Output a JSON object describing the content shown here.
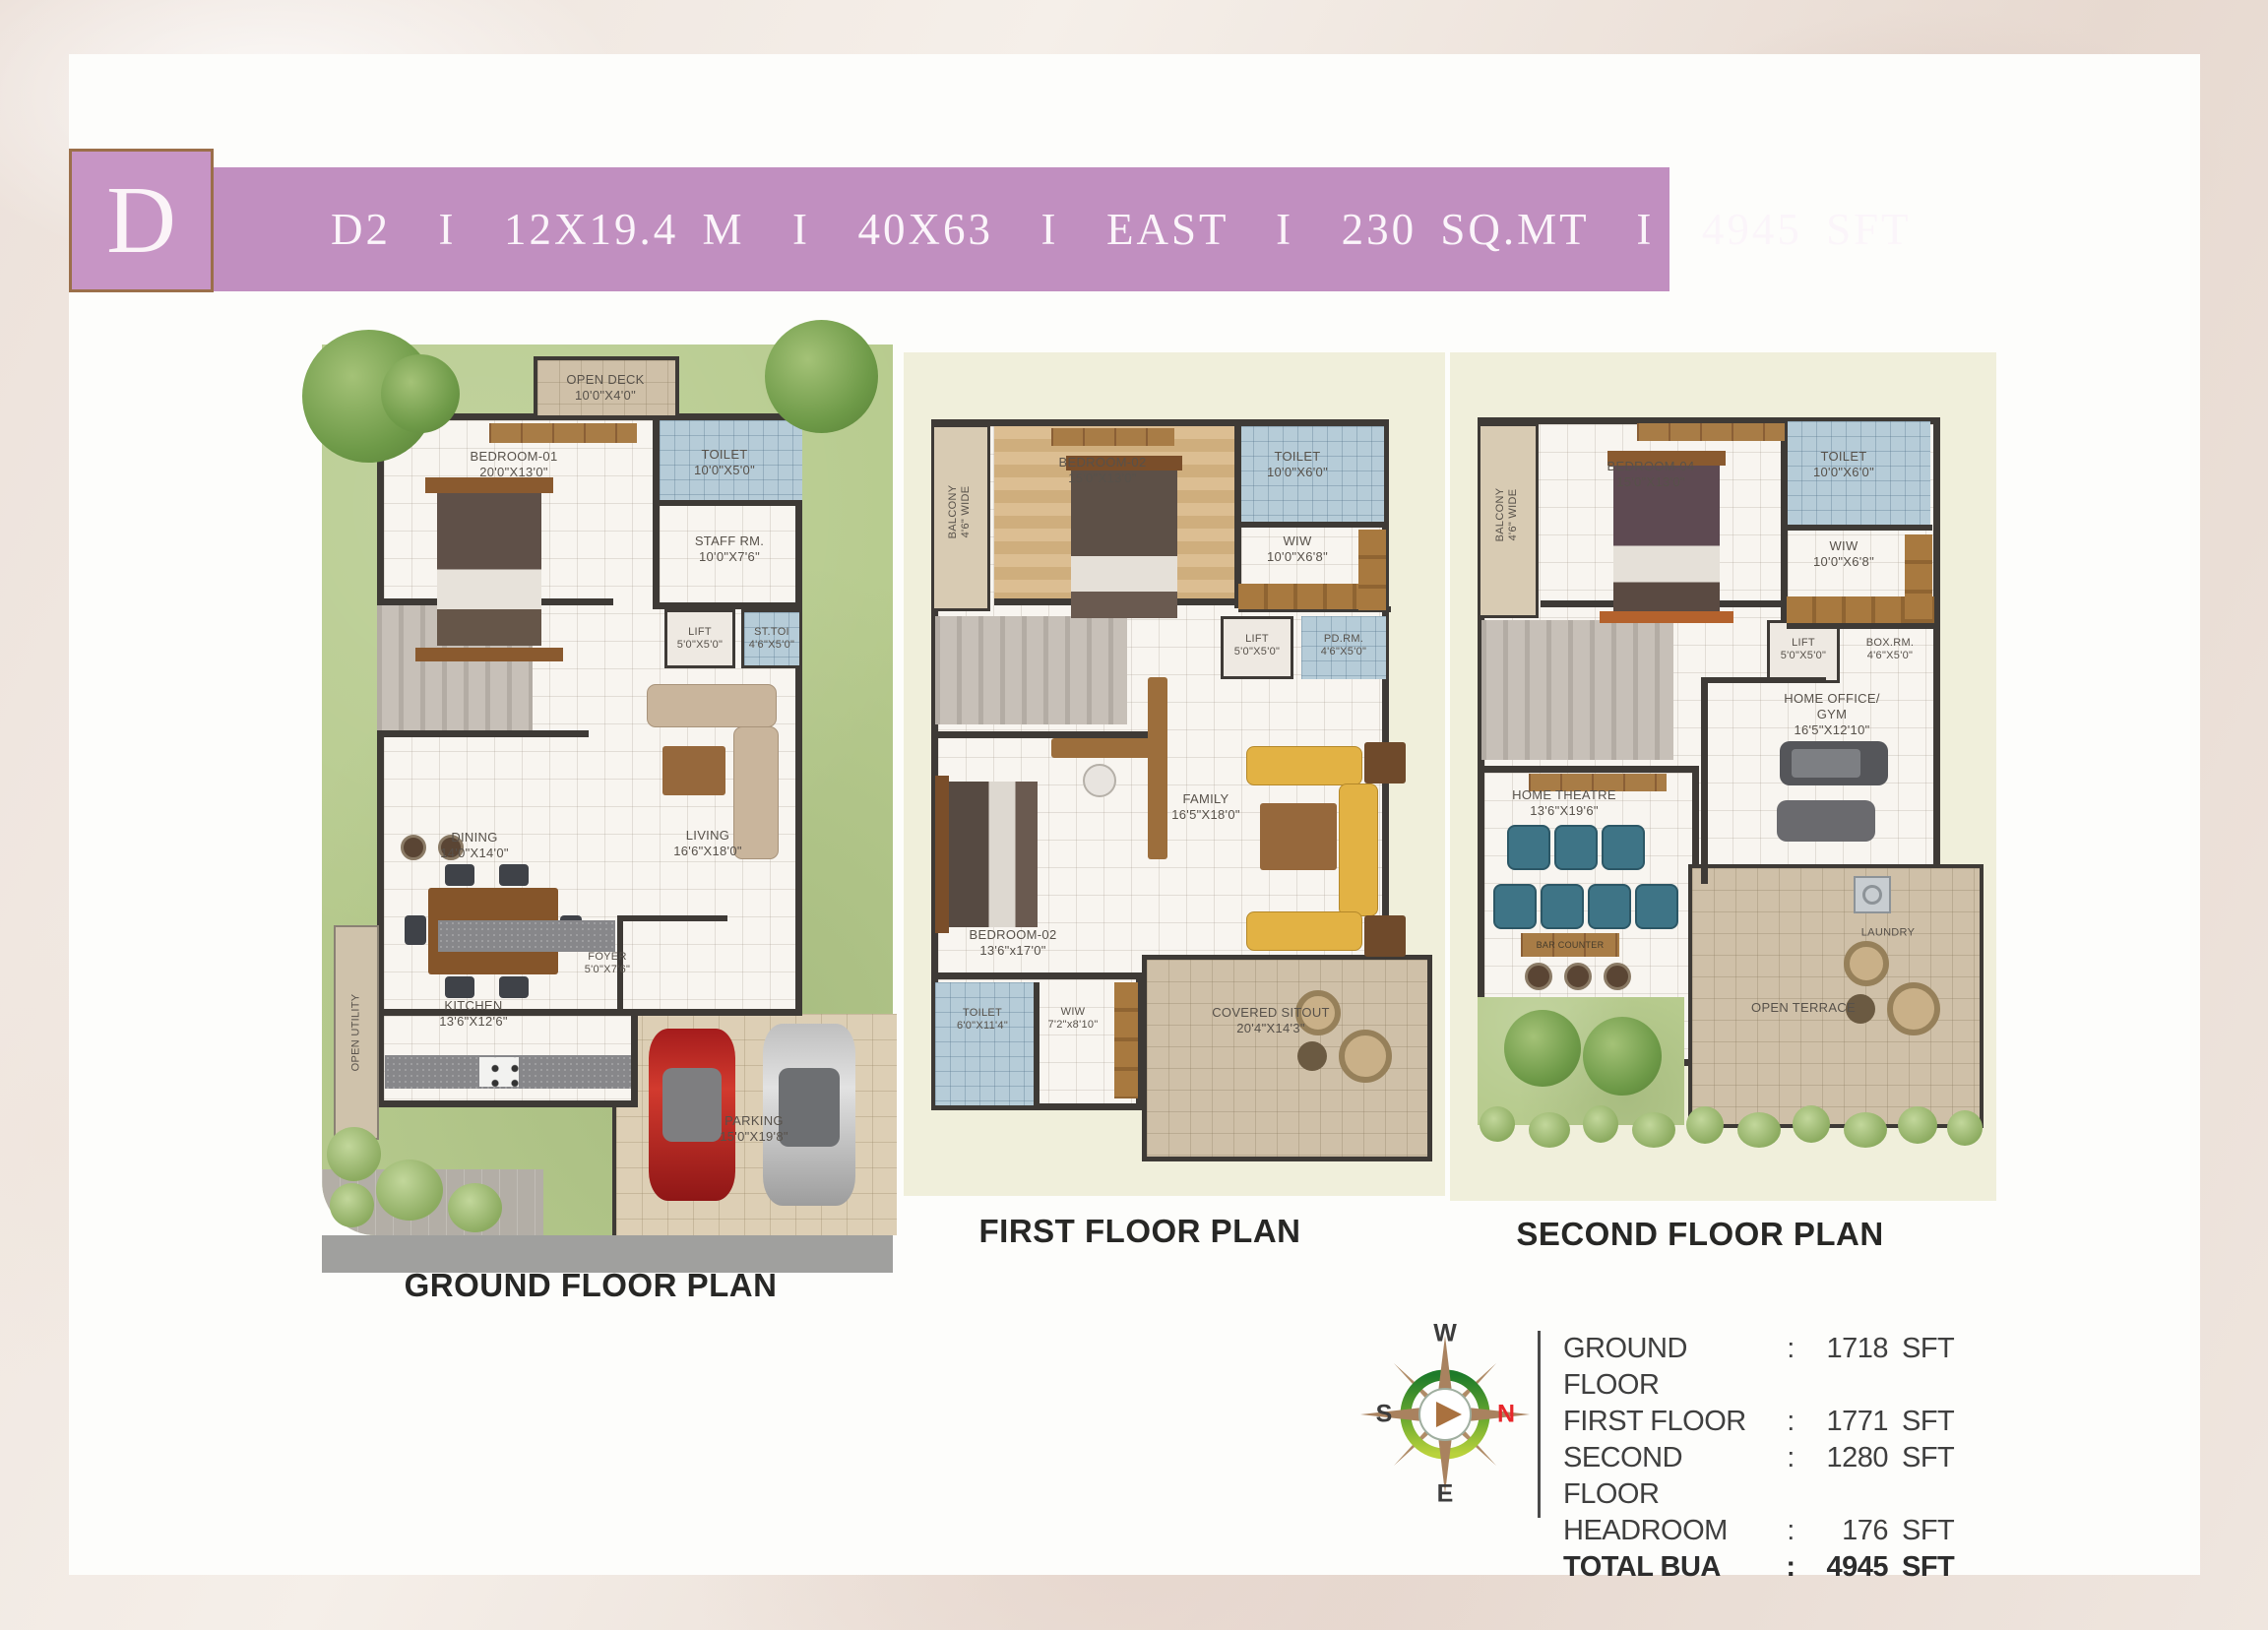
{
  "badge": {
    "letter": "D"
  },
  "banner": {
    "text": "D2  I  12X19.4 M  I  40X63  I  EAST  I  230 SQ.MT  I  4945 SFT",
    "bg": "#c18fc0"
  },
  "plans": {
    "ground": {
      "title": "GROUND FLOOR PLAN",
      "rooms": {
        "open_deck": {
          "name": "OPEN DECK",
          "dims": "10'0\"X4'0\""
        },
        "bedroom01": {
          "name": "BEDROOM-01",
          "dims": "20'0\"X13'0\""
        },
        "toilet": {
          "name": "TOILET",
          "dims": "10'0\"X5'0\""
        },
        "staff": {
          "name": "STAFF RM.",
          "dims": "10'0\"X7'6\""
        },
        "lift": {
          "name": "LIFT",
          "dims": "5'0\"X5'0\""
        },
        "sttoi": {
          "name": "ST.TOI",
          "dims": "4'6\"X5'0\""
        },
        "living": {
          "name": "LIVING",
          "dims": "16'6\"X18'0\""
        },
        "dining": {
          "name": "DINING",
          "dims": "14'0\"X14'0\""
        },
        "kitchen": {
          "name": "KITCHEN",
          "dims": "13'6\"X12'6\""
        },
        "foyer": {
          "name": "FOYER",
          "dims": "5'0\"X7'6\""
        },
        "utility": {
          "name": "OPEN UTILITY"
        },
        "parking": {
          "name": "PARKING",
          "dims": "15'0\"X19'8\""
        }
      }
    },
    "first": {
      "title": "FIRST FLOOR PLAN",
      "rooms": {
        "balcony": {
          "name": "BALCONY",
          "dims": "4'6\" WIDE"
        },
        "bedroom02a": {
          "name": "BEDROOM-02",
          "dims": "15'0\"X13'0\""
        },
        "toilet_top": {
          "name": "TOILET",
          "dims": "10'0\"X6'0\""
        },
        "wiw_top": {
          "name": "WIW",
          "dims": "10'0\"X6'8\""
        },
        "lift": {
          "name": "LIFT",
          "dims": "5'0\"X5'0\""
        },
        "pdrm": {
          "name": "PD.RM.",
          "dims": "4'6\"X5'0\""
        },
        "family": {
          "name": "FAMILY",
          "dims": "16'5\"X18'0\""
        },
        "bedroom02b": {
          "name": "BEDROOM-02",
          "dims": "13'6\"x17'0\""
        },
        "toilet_bottom": {
          "name": "TOILET",
          "dims": "6'0\"X11'4\""
        },
        "wiw_bottom": {
          "name": "WIW",
          "dims": "7'2\"x8'10\""
        },
        "sitout": {
          "name": "COVERED SITOUT",
          "dims": "20'4\"X14'3\""
        }
      }
    },
    "second": {
      "title": "SECOND FLOOR PLAN",
      "rooms": {
        "balcony": {
          "name": "BALCONY",
          "dims": "4'6\" WIDE"
        },
        "bedroom04": {
          "name": "BEDROOM-04",
          "dims": "15'0\"X13'0\""
        },
        "toilet": {
          "name": "TOILET",
          "dims": "10'0\"X6'0\""
        },
        "wiw": {
          "name": "WIW",
          "dims": "10'0\"X6'8\""
        },
        "lift": {
          "name": "LIFT",
          "dims": "5'0\"X5'0\""
        },
        "boxrm": {
          "name": "BOX.RM.",
          "dims": "4'6\"X5'0\""
        },
        "office": {
          "name": "HOME OFFICE/",
          "name2": "GYM",
          "dims": "16'5\"X12'10\""
        },
        "theatre": {
          "name": "HOME THEATRE",
          "dims": "13'6\"X19'6\""
        },
        "bar": {
          "name": "BAR COUNTER"
        },
        "laundry": {
          "name": "LAUNDRY"
        },
        "terrace": {
          "name": "OPEN TERRACE"
        }
      }
    }
  },
  "compass": {
    "n": "N",
    "s": "S",
    "e": "E",
    "w": "W"
  },
  "area_table": {
    "colon": ":",
    "rows": [
      {
        "label": "GROUND FLOOR",
        "value": "1718",
        "unit": "SFT"
      },
      {
        "label": "FIRST FLOOR",
        "value": "1771",
        "unit": "SFT"
      },
      {
        "label": "SECOND FLOOR",
        "value": "1280",
        "unit": "SFT"
      },
      {
        "label": "HEADROOM",
        "value": "176",
        "unit": "SFT"
      },
      {
        "label": "TOTAL BUA",
        "value": "4945",
        "unit": "SFT"
      }
    ]
  }
}
